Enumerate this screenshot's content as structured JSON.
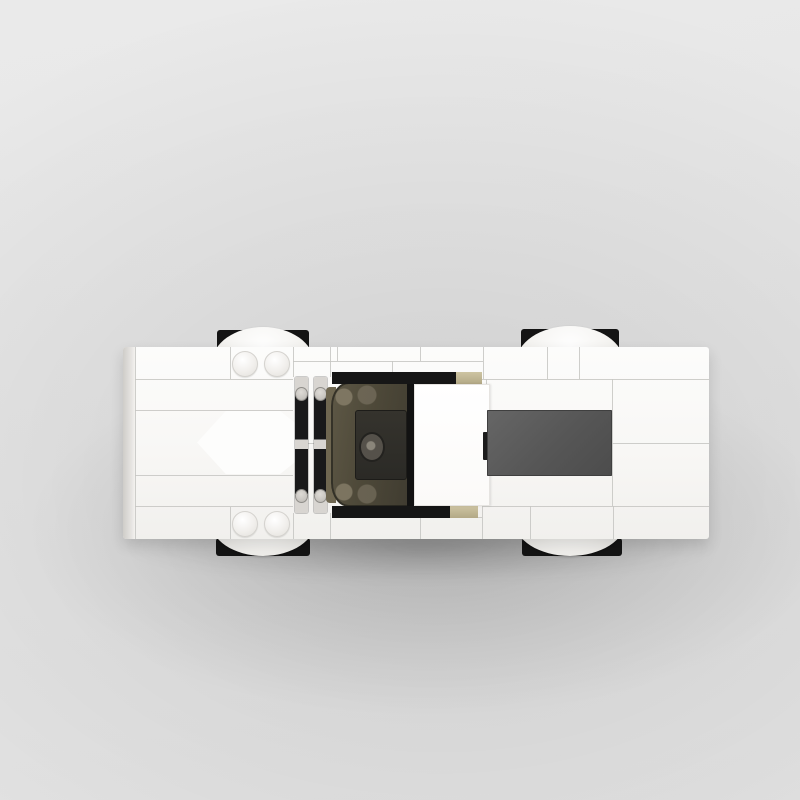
{
  "image": {
    "type": "product-render",
    "subject": "Top-down overhead view of a white brick-built toy sports car",
    "text_content": "none",
    "background": {
      "base_color": "#e7e7e7",
      "shadow_region_color": "#c2c2c2"
    }
  },
  "car": {
    "style": "LEGO-like brick construction",
    "view": "top-down, front pointing left",
    "body_color": "#f8f7f5",
    "panel_seam_color": "#c6c5c2",
    "left_edge_color": "#cfcdc9",
    "hood_arrow": {
      "shape": "left-pointing chevron wedge",
      "color": "#fdfdfc"
    },
    "stud_pairs": {
      "count": 4,
      "color": "#f1efec"
    },
    "grille": {
      "light_color": "#d8d5d1",
      "dark_color": "#19191a",
      "columns": 2
    },
    "windshield": {
      "tint_color": "#4e4939",
      "frame_color": "#121212",
      "interior_tan": "#6f6751"
    },
    "cockpit": {
      "dashboard_color": "#2b2a26",
      "steering_wheel_color": "#55514a"
    },
    "roof_color": "#ffffff",
    "rear_window_color": "#565656",
    "trim": {
      "black": "#161616",
      "tan": "#c2b896"
    },
    "wheels": {
      "count": 4,
      "tire_color": "#141414",
      "cover_color": "#f6f5f3"
    }
  }
}
